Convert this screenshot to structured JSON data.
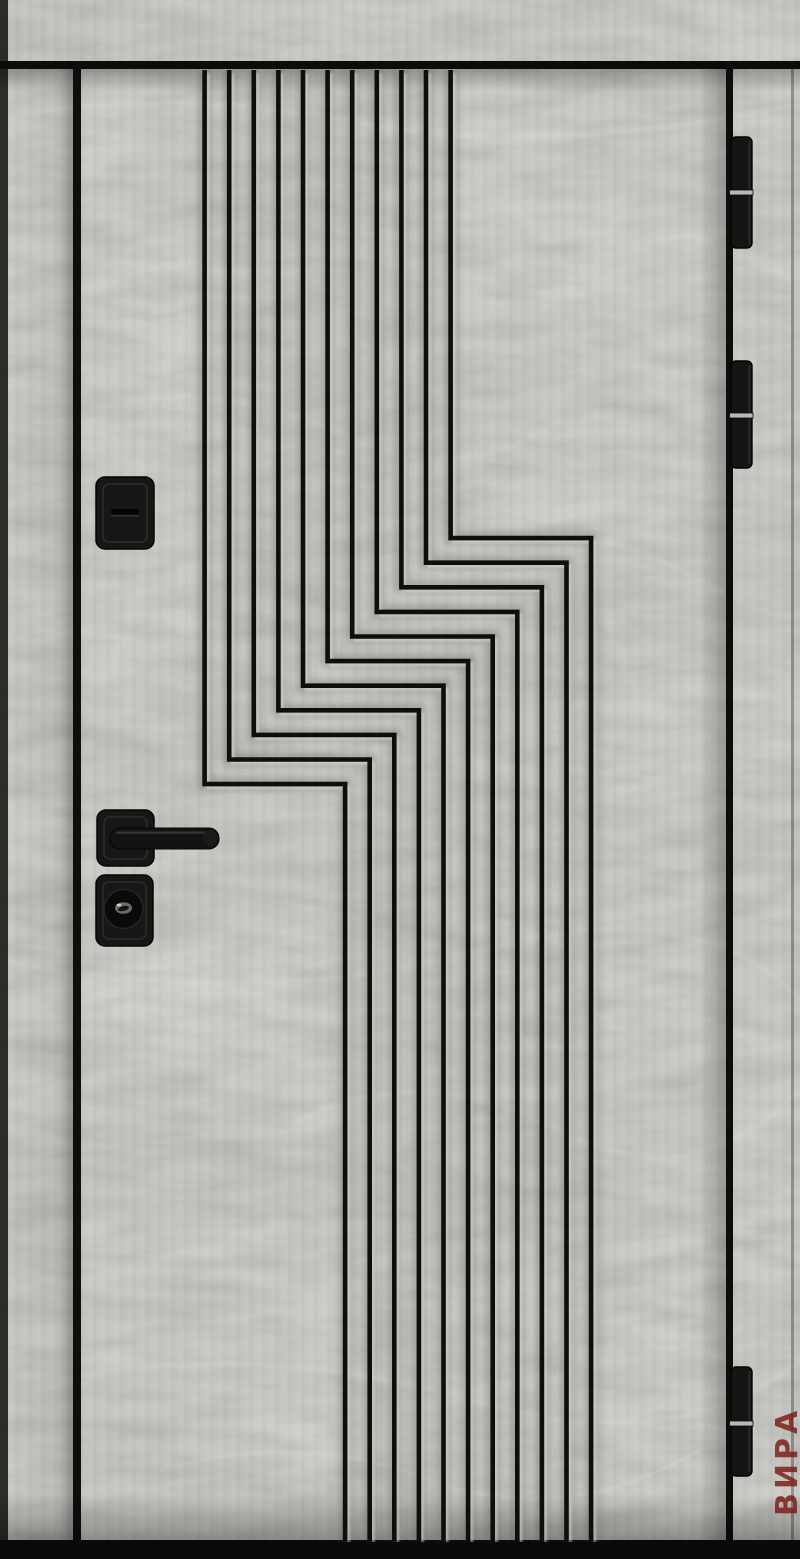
{
  "photo": {
    "subject": "entry-door-front-view",
    "watermark": {
      "text": "ВИРА"
    }
  },
  "colors": {
    "base": "#b6b5b1",
    "base_light": "#c6c5c1",
    "groove": "#0e0e0d",
    "frame_line": "#0c0c0b",
    "floor_strip": "#0a0a0a",
    "hardware": "#171716",
    "hardware_edge": "#2e2e2d",
    "metal_band": "#b9b8b4",
    "watermark_red": "#7c1b16"
  },
  "pattern": {
    "line_count": 11,
    "top_x_start": 204.6,
    "spacing": 24.6,
    "jog_y_right": 538.1,
    "jog_run": 140.5,
    "top_y": 70,
    "bottom_y": 1542
  },
  "hardware": {
    "deadbolt": {
      "x": 96,
      "y": 477,
      "w": 58,
      "h": 72,
      "slot_y": 511
    },
    "handle_rose": {
      "x": 97,
      "y": 810,
      "w": 57,
      "h": 56
    },
    "lever": {
      "x1": 110,
      "x2": 219,
      "y": 828,
      "h": 21
    },
    "cylinder_plate": {
      "x": 96,
      "y": 875,
      "w": 57,
      "h": 71
    },
    "cylinder": {
      "cx": 123.5,
      "cy": 909,
      "r": 19.5
    }
  },
  "hinges": [
    {
      "y": 137,
      "h": 111,
      "band_y": 190
    },
    {
      "y": 361,
      "h": 107,
      "band_y": 413
    },
    {
      "y": 1367,
      "h": 109,
      "band_y": 1421
    }
  ]
}
